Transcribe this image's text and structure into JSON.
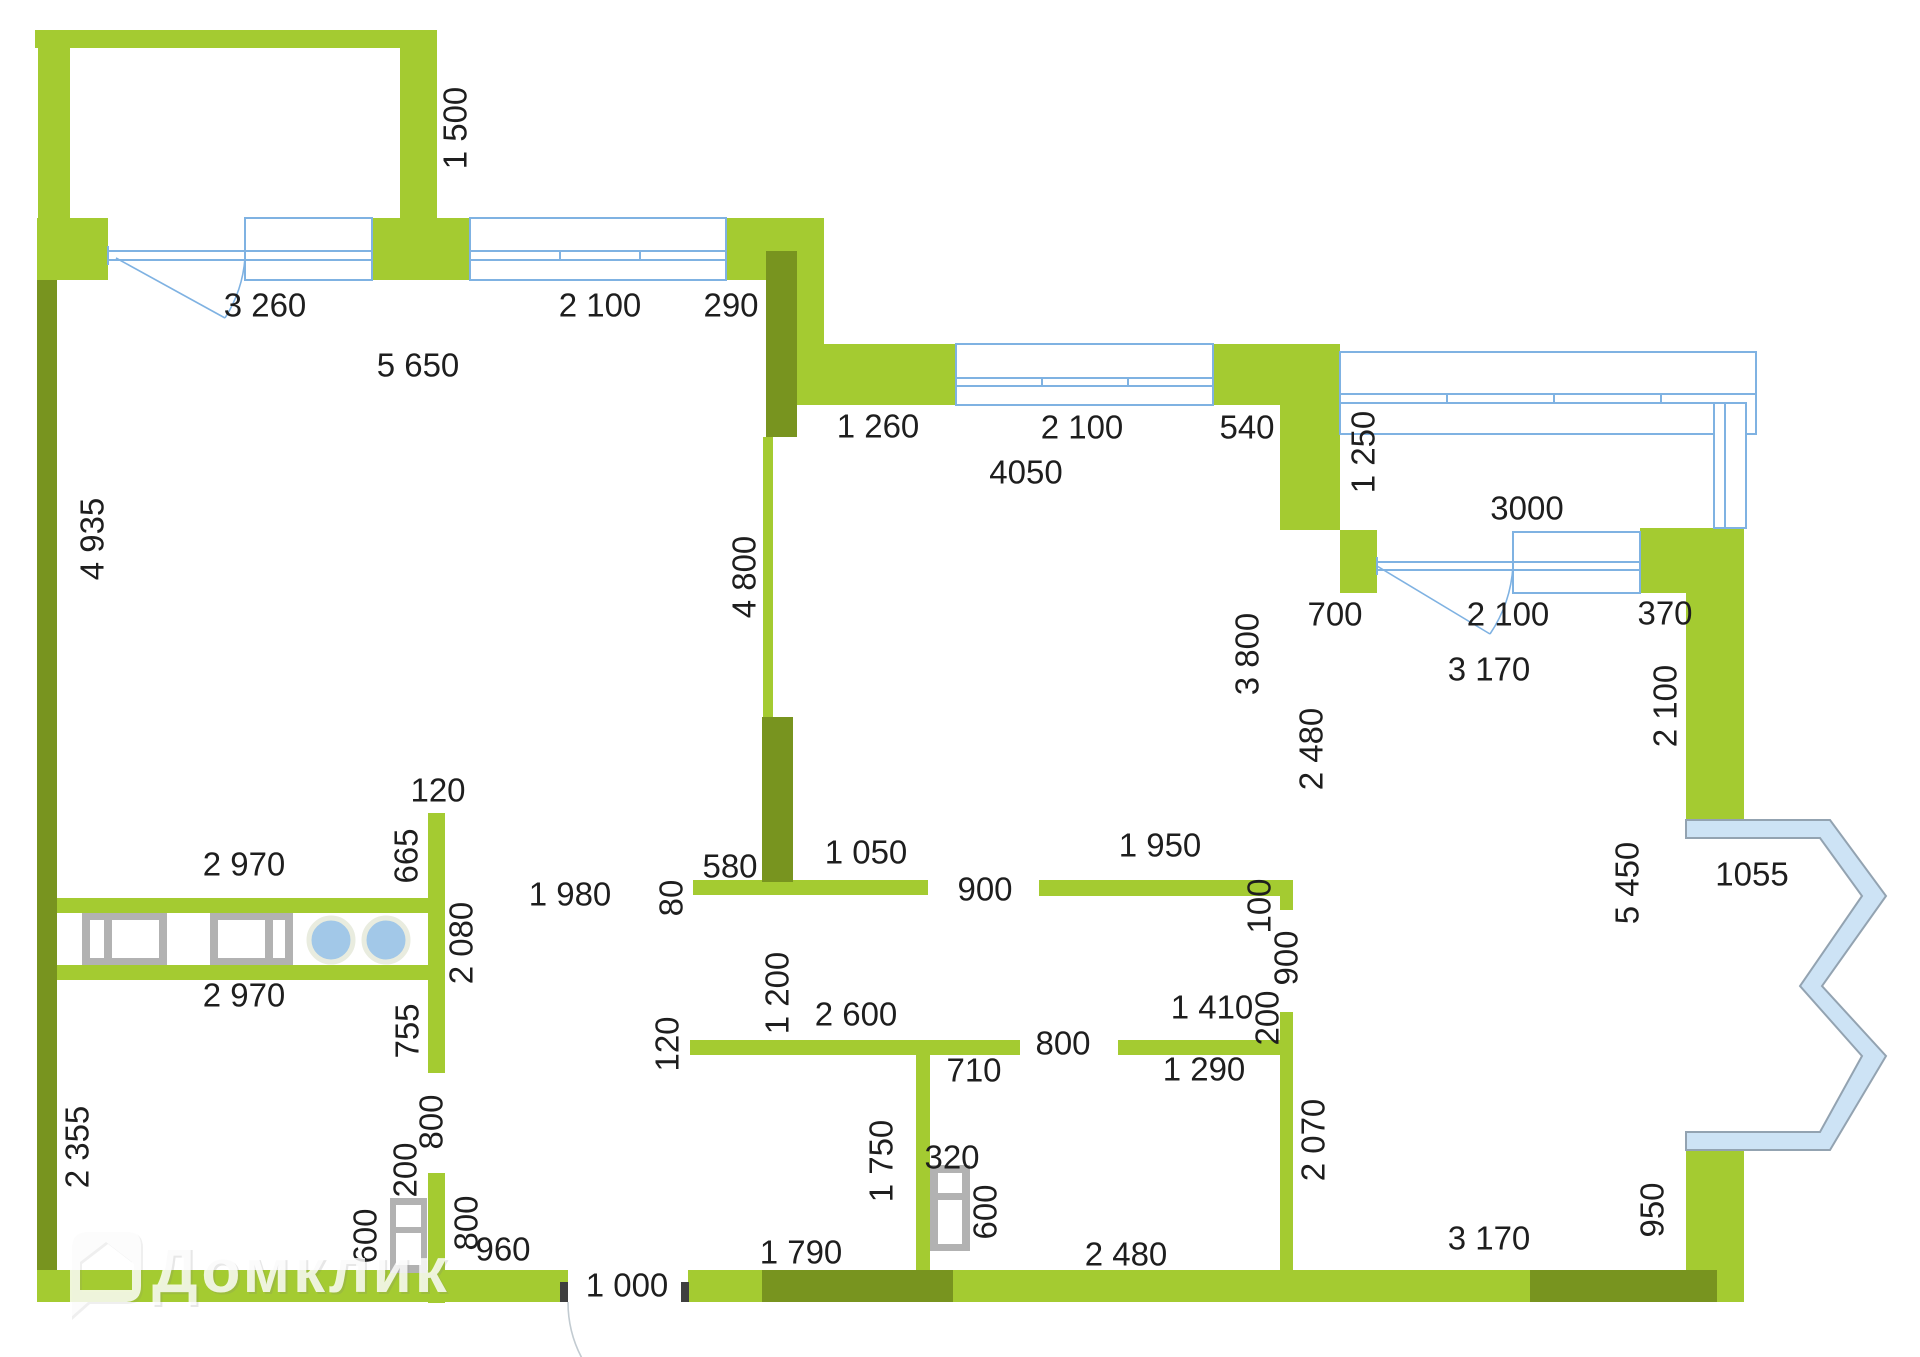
{
  "watermark": {
    "brand_label": "Домклик"
  },
  "colors": {
    "wall_light_green": "#a4cb31",
    "wall_dark_olive": "#78941f",
    "window_blue": "#7fb2e2",
    "bay_fill": "#cde3f5",
    "bay_stroke": "#93a3b1",
    "fixture_gray": "#b2b2b2",
    "burner_blue": "#a2c8e8",
    "dimension_text": "#1e1e1e"
  },
  "labels": [
    {
      "text": "1 500",
      "x": 458,
      "y": 128,
      "vertical": true
    },
    {
      "text": "3 260",
      "x": 265,
      "y": 308,
      "vertical": false
    },
    {
      "text": "2 100",
      "x": 600,
      "y": 308,
      "vertical": false
    },
    {
      "text": "290",
      "x": 731,
      "y": 308,
      "vertical": false
    },
    {
      "text": "5 650",
      "x": 418,
      "y": 368,
      "vertical": false
    },
    {
      "text": "1 260",
      "x": 878,
      "y": 429,
      "vertical": false
    },
    {
      "text": "2 100",
      "x": 1082,
      "y": 430,
      "vertical": false
    },
    {
      "text": "540",
      "x": 1247,
      "y": 430,
      "vertical": false
    },
    {
      "text": "4050",
      "x": 1026,
      "y": 475,
      "vertical": false
    },
    {
      "text": "1 250",
      "x": 1366,
      "y": 452,
      "vertical": true
    },
    {
      "text": "3000",
      "x": 1527,
      "y": 511,
      "vertical": false
    },
    {
      "text": "700",
      "x": 1335,
      "y": 617,
      "vertical": false
    },
    {
      "text": "2 100",
      "x": 1508,
      "y": 617,
      "vertical": false
    },
    {
      "text": "370",
      "x": 1665,
      "y": 616,
      "vertical": false
    },
    {
      "text": "3 170",
      "x": 1489,
      "y": 672,
      "vertical": false
    },
    {
      "text": "4 935",
      "x": 95,
      "y": 539,
      "vertical": true
    },
    {
      "text": "4 800",
      "x": 747,
      "y": 577,
      "vertical": true
    },
    {
      "text": "3 800",
      "x": 1250,
      "y": 654,
      "vertical": true
    },
    {
      "text": "2 480",
      "x": 1314,
      "y": 749,
      "vertical": true
    },
    {
      "text": "2 100",
      "x": 1668,
      "y": 706,
      "vertical": true
    },
    {
      "text": "5 450",
      "x": 1630,
      "y": 883,
      "vertical": true
    },
    {
      "text": "1055",
      "x": 1752,
      "y": 877,
      "vertical": false
    },
    {
      "text": "120",
      "x": 438,
      "y": 793,
      "vertical": false
    },
    {
      "text": "665",
      "x": 409,
      "y": 856,
      "vertical": true
    },
    {
      "text": "2 970",
      "x": 244,
      "y": 867,
      "vertical": false
    },
    {
      "text": "2 080",
      "x": 464,
      "y": 943,
      "vertical": true
    },
    {
      "text": "2 970",
      "x": 244,
      "y": 998,
      "vertical": false
    },
    {
      "text": "755",
      "x": 410,
      "y": 1031,
      "vertical": true
    },
    {
      "text": "2 355",
      "x": 80,
      "y": 1147,
      "vertical": true
    },
    {
      "text": "1 980",
      "x": 570,
      "y": 897,
      "vertical": false
    },
    {
      "text": "80",
      "x": 674,
      "y": 898,
      "vertical": true
    },
    {
      "text": "580",
      "x": 730,
      "y": 869,
      "vertical": false
    },
    {
      "text": "1 050",
      "x": 866,
      "y": 855,
      "vertical": false
    },
    {
      "text": "900",
      "x": 985,
      "y": 892,
      "vertical": false
    },
    {
      "text": "1 950",
      "x": 1160,
      "y": 848,
      "vertical": false
    },
    {
      "text": "100",
      "x": 1262,
      "y": 906,
      "vertical": true
    },
    {
      "text": "900",
      "x": 1289,
      "y": 958,
      "vertical": true
    },
    {
      "text": "1 200",
      "x": 780,
      "y": 993,
      "vertical": true
    },
    {
      "text": "2 600",
      "x": 856,
      "y": 1017,
      "vertical": false
    },
    {
      "text": "120",
      "x": 670,
      "y": 1044,
      "vertical": true
    },
    {
      "text": "800",
      "x": 1063,
      "y": 1046,
      "vertical": false
    },
    {
      "text": "1 410",
      "x": 1212,
      "y": 1010,
      "vertical": false
    },
    {
      "text": "200",
      "x": 1270,
      "y": 1018,
      "vertical": true
    },
    {
      "text": "710",
      "x": 974,
      "y": 1073,
      "vertical": false
    },
    {
      "text": "1 290",
      "x": 1204,
      "y": 1072,
      "vertical": false
    },
    {
      "text": "2 070",
      "x": 1316,
      "y": 1140,
      "vertical": true
    },
    {
      "text": "1 750",
      "x": 884,
      "y": 1161,
      "vertical": true
    },
    {
      "text": "320",
      "x": 952,
      "y": 1160,
      "vertical": false
    },
    {
      "text": "600",
      "x": 988,
      "y": 1212,
      "vertical": true
    },
    {
      "text": "2 480",
      "x": 1126,
      "y": 1257,
      "vertical": false
    },
    {
      "text": "1 790",
      "x": 801,
      "y": 1255,
      "vertical": false
    },
    {
      "text": "800",
      "x": 434,
      "y": 1122,
      "vertical": true
    },
    {
      "text": "200",
      "x": 408,
      "y": 1170,
      "vertical": true
    },
    {
      "text": "600",
      "x": 368,
      "y": 1236,
      "vertical": true
    },
    {
      "text": "800",
      "x": 469,
      "y": 1223,
      "vertical": true
    },
    {
      "text": "960",
      "x": 503,
      "y": 1252,
      "vertical": false
    },
    {
      "text": "1 000",
      "x": 627,
      "y": 1288,
      "vertical": false
    },
    {
      "text": "3 170",
      "x": 1489,
      "y": 1241,
      "vertical": false
    },
    {
      "text": "950",
      "x": 1655,
      "y": 1210,
      "vertical": true
    }
  ]
}
